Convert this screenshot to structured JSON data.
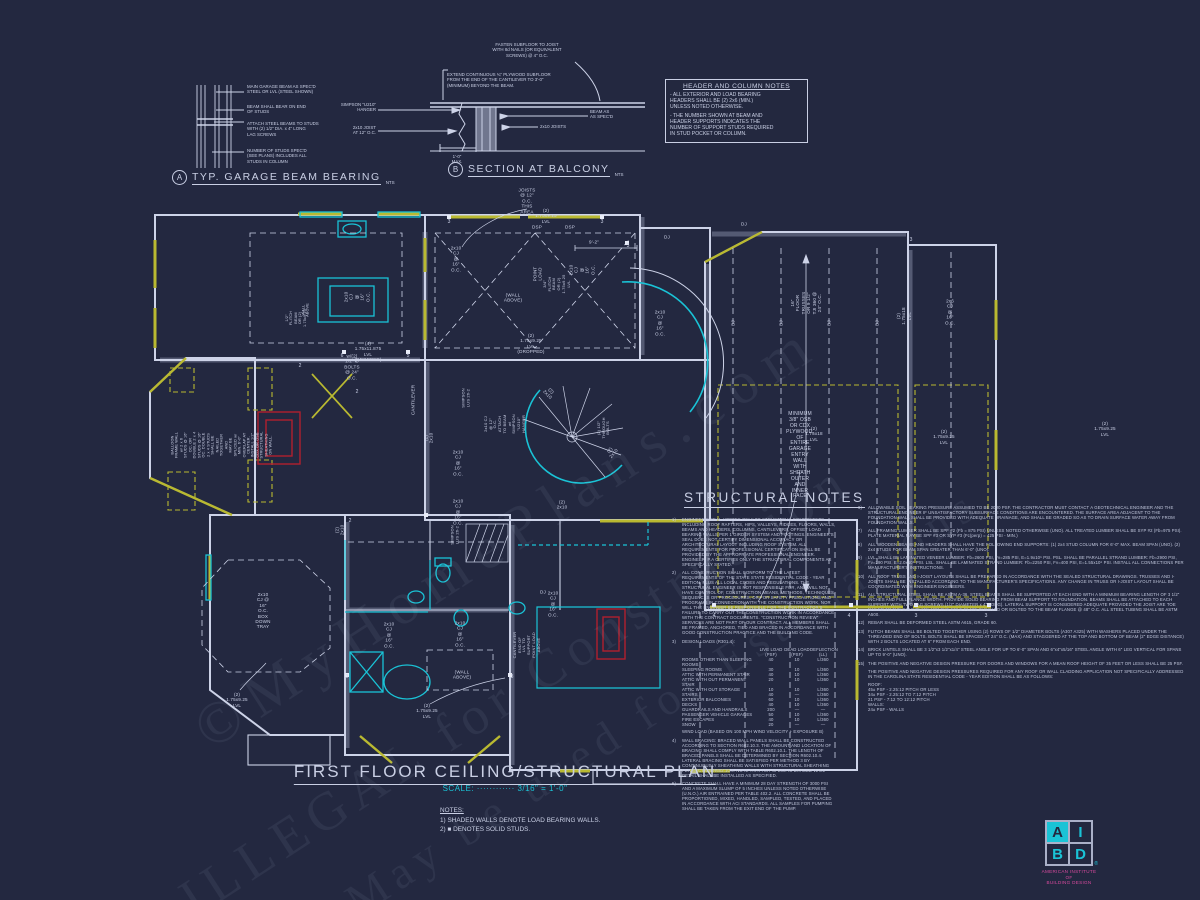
{
  "colors": {
    "bg": "#232840",
    "line": "#cdd3e8",
    "cyan": "#1ac3d6",
    "yellow": "#b9b931",
    "red": "#b01f2e",
    "magenta": "#d84a9e"
  },
  "watermark": {
    "lines": [
      "©MyHomePlans.com",
      "ILLEGAL for Construction",
      "May be used for Estimations"
    ]
  },
  "details": {
    "garage_beam": {
      "tag": "A",
      "title": "TYP. GARAGE BEAM BEARING",
      "nts": "NTS",
      "notes": [
        "MAIN GARAGE BEAM AS SPEC'D\nSTEEL OR LVL (STEEL SHOWN)",
        "BEAM SHALL BEAR ON END\nOF STUDS",
        "ATTACH STEEL BEAMS TO STUDS\nWITH (2) 1/2\" DIA. x 4\" LONG\nLAG SCREWS",
        "NUMBER OF STUDS SPEC'D\n(SEE PLANS) INCLUDES ALL\nSTUDS IN COLUMN"
      ]
    },
    "balcony": {
      "tag": "B",
      "title": "SECTION AT BALCONY",
      "nts": "NTS",
      "note_fasten": "FASTEN SUBFLOOR TO JOIST\nWITH 8d NAILS (OR EQUIVALENT\nSCREWS) @ 4\" O.C.",
      "note_extend": "EXTEND CONTINUOUS ¾\" PLYWOOD SUBFLOOR\nFROM THE END OF THE CANTILEVER TO 3'-0\"\n(MINIMUM) BEYOND THE BEAM.",
      "label_hanger": "SIMPSON \"U210\"\nHANGER",
      "label_joist": "2x10 JOIST\nAT 12\" O.C.",
      "label_beam": "BEAM AS\nAS SPEC'D",
      "label_joists2": "2x10 JOISTS",
      "label_max": "1'-0\"\nMAX."
    }
  },
  "header_notes": {
    "title": "HEADER AND COLUMN NOTES",
    "body": [
      "- ALL EXTERIOR AND LOAD BEARING\nHEADERS SHALL BE (2) 2x6 (MIN.)\nUNLESS NOTED OTHERWISE.",
      "- THE NUMBER SHOWN AT BEAM AND\nHEADER SUPPORTS INDICATES THE\nNUMBER OF SUPPORT STUDS REQUIRED\nIN STUD POCKET OR COLUMN."
    ]
  },
  "structural_notes": {
    "title": "STRUCTURAL NOTES",
    "left": [
      {
        "n": "1)",
        "t": "ENGINEER'S SEAL APPLIES ONLY TO STRUCTURAL COMPONENTS INCLUDING ROOF RAFTERS, HIPS, VALLEYS, RIDGES, FLOORS, WALLS, BEAMS AND HEADERS, COLUMNS, CANTILEVERS, OFFSET LOAD BEARING WALLS PER 1 GIRDER SYSTEM AND FOOTINGS.  ENGINEER'S SEAL DOES NOT CERTIFY DIMENSIONAL ACCURACY OR ARCHITECTURAL LAYOUT INCLUDING ROOF SYSTEM. ALL REQUIREMENTS FOR PROFESSIONAL CERTIFICATION SHALL BE PROVIDED BY THE APPROPRIATE PROFESSIONAL ENGINEER. ENGINEER, P.A CERTIFIES ONLY THE STRUCTURAL COMPONENTS AS SPECIFICALLY STATED."
      },
      {
        "n": "2)",
        "t": "ALL CONSTRUCTION SHALL CONFORM TO THE LATEST REQUIREMENTS OF THE STATE STATE RESIDENTIAL CODE - YEAR EDITION, PLUS ALL LOCAL CODES AND REGULATIONS. THE STRUCTURAL ENGINEER IS NOT RESPONSIBLE FOR, AND WILL NOT HAVE CONTROL OF, CONSTRUCTION MEANS, METHODS, TECHNIQUES, SEQUENCES OR PROCEDURES, OR FOR SAFETY PRECAUTIONS AND PROGRAMS IN CONNECTION WITH THE CONSTRUCTION WORK, NOR WILL THE ENGINEER BE RESPONSIBLE FOR THE CONTRACTOR'S FAILURE TO CARRY OUT THE CONSTRUCTION WORK IN ACCORDANCE WITH THE CONTRACT DOCUMENTS. \"CONSTRUCTION REVIEW\" SERVICES ARE NOT PART OF OUR CONTRACT. ALL MEMBERS SHALL BE FRAMED, ANCHORED, TIED AND BRACED IN ACCORDANCE WITH GOOD CONSTRUCTION PRACTICE AND THE BUILDING CODE."
      },
      {
        "table": true,
        "n": "3)"
      },
      {
        "n": "4)",
        "t": "WALL BRACING:  BRACED WALL PANELS SHALL BE CONSTRUCTED ACCORDING TO SECTION R602.10.3. THE AMOUNT AND LOCATION OF BRACING SHALL COMPLY WITH TABLE R602.10.1. THE LENGTH OF BRACED PANELS SHALL BE DETERMINED BY SECTION R602.10.4. LATERAL BRACING SHALL BE SATISFIED PER METHOD 3 BY CONTINUOUSLY SHEATHING WALLS WITH STRUCTURAL SHEATHING PER SECTION R602.10.3. NOTE THAT ANY SPECIFIC BRACED WALL DETAIL SHALL BE INSTALLED AS SPECIFIED."
      },
      {
        "n": "5)",
        "t": "CONCRETE SHALL HAVE A MINIMUM 28 DAY STRENGTH OF 3000 PSI AND A MAXIMUM SLUMP OF 5 INCHES UNLESS NOTED OTHERWISE (U.N.O.) AIR ENTRAINED PER TABLE 402.2. ALL CONCRETE SHALL BE PROPORTIONED, MIXED, HANDLED, SAMPLED, TESTED, AND PLACED IN ACCORDANCE WITH ACI STANDARDS. ALL SAMPLES FOR PUMPING SHALL BE TAKEN FROM THE EXIT END OF THE PUMP."
      }
    ],
    "table": {
      "title": "DESIGN LOADS (R301.4):",
      "col_headers": [
        "LIVE LOAD\n(PSF)",
        "DEAD LOAD\n(PSF)",
        "DEFLECTION\n(LL)"
      ],
      "rows": [
        [
          "ROOMS OTHER THAN SLEEPING ROOMS",
          "40",
          "10",
          "L/360"
        ],
        [
          "SLEEPING ROOMS",
          "30",
          "10",
          "L/360"
        ],
        [
          "ATTIC WITH PERMANENT STAIR",
          "40",
          "10",
          "L/360"
        ],
        [
          "ATTIC WITH OUT PERMANENT STAIR",
          "20",
          "10",
          "L/360"
        ],
        [
          "ATTIC WITH OUT STORAGE",
          "10",
          "10",
          "L/360"
        ],
        [
          "STAIRS",
          "40",
          "—",
          "L/360"
        ],
        [
          "EXTERIOR BALCONIES",
          "60",
          "10",
          "L/360"
        ],
        [
          "DECKS",
          "40",
          "10",
          "L/360"
        ],
        [
          "GUARDRAILS AND HANDRAILS",
          "200",
          "—",
          "—"
        ],
        [
          "PASSENGER VEHICLE GARAGES",
          "50",
          "10",
          "L/360"
        ],
        [
          "FIRE ESCAPES",
          "40",
          "10",
          "L/360"
        ],
        [
          "SNOW",
          "20",
          "—",
          "—"
        ]
      ],
      "wind": "WIND LOAD        (BASED ON 100 MPH WIND VELOCITY + EXPOSURE B)"
    },
    "right": [
      {
        "n": "6)",
        "t": "ALLOWABLE SOIL BEARING PRESSURE ASSUMED TO BE 2000 PSF. THE CONTRACTOR MUST CONTACT A GEOTECHNICAL ENGINEER AND THE STRUCTURAL ENGINEER IF UNSATISFACTORY SUBSURFACE CONDITIONS ARE ENCOUNTERED. THE SURFACE AREA ADJACENT TO THE FOUNDATION WALL SHALL BE PROVIDED WITH ADEQUATE DRAINAGE, AND SHALL BE GRADED SO AS TO DRAIN SURFACE WATER AWAY FROM FOUNDATION WALLS."
      },
      {
        "n": "7)",
        "t": "ALL FRAMING LUMBER SHALL BE SPF #2 (Fb = 875 PSI) UNLESS NOTED OTHERWISE (UNO). ALL TREATED LUMBER SHALL BE SYP #2 (Fb=975 PSI). PLATE MATERIAL MAY BE SPF #3 OR SYP #3 (Fc(perp) = 425 PSI - MIN.)"
      },
      {
        "n": "8)",
        "t": "ALL WOODEN BEAMS AND HEADERS SHALL HAVE THE FOLLOWING END SUPPORTS: (1) 2x4 STUD COLUMN FOR 6'-0\" MAX. BEAM SPAN (UNO). (2) 2x4 STUDS FOR BEAM SPAN GREATER THAN 6'-0\" (UNO)."
      },
      {
        "n": "9)",
        "t": "LVL. SHALL BE LAMINATED VENEER LUMBER: Fb=2600 PSI, Fv=285 PSI, E=1.9x10⁶ PSI. PSL. SHALL BE PARALLEL STRAND LUMBER: Fb=2900 PSI, Fv=290 PSI, E=2.0x10⁶ PSI. LSL. SHALL BE LAMINATED STRAND LUMBER: Fb=2250 PSI, Fv=400 PSI, E=1.55x10⁶ PSI. INSTALL ALL CONNECTIONS PER MANUFACTURER'S INSTRUCTIONS."
      },
      {
        "n": "10)",
        "t": "ALL ROOF TRUSS AND I-JOIST LAYOUTS SHALL BE PREPARED IN ACCORDANCE WITH THE SEALED STRUCTURAL DRAWINGS. TRUSSES AND I-JOISTS SHALL BE INSTALLED ACCORDING TO THE MANUFACTURER'S SPECIFICATIONS. ANY CHANGE IN TRUSS OR I-JOIST LAYOUT SHALL BE COORDINATED WITH ENGINEER ENGINEERS."
      },
      {
        "n": "11)",
        "t": "ALL STRUCTURAL STEEL SHALL BE ASTM A-36. STEEL BEAMS SHALL BE SUPPORTED AT EACH END WITH A MINIMUM BEARING LENGTH OF 3 1/2\" INCHES AND FULL FLANGE WIDTH. PROVIDE SOLID BEARING FROM BEAM SUPPORT TO FOUNDATION. BEAMS SHALL BE ATTACHED TO EACH SUPPORT WITH TWO LAG SCREWS (1/2\" DIAMETER x 4\" LONG). LATERAL SUPPORT IS CONSIDERED ADEQUATE PROVIDED THE JOIST ARE TOE NAILED TO THE SOLE PLATE AND THE SOLE PLATE IS NAILED OR BOLTED TO THE BEAM FLANGE @ 48\" O.C. ALL STEEL TUBING SHALL BE ASTM A500."
      },
      {
        "n": "12)",
        "t": "REBAR SHALL BE DEFORMED STEEL ASTM A615, GRADE 60."
      },
      {
        "n": "13)",
        "t": "FLITCH BEAMS SHALL BE BOLTED TOGETHER USING (2) ROWS OF 1/2\" DIAMETER BOLTS (A307 A325) WITH WASHERS PLACED UNDER THE THREADED END OF BOLTS. BOLTS SHALL BE SPACED AT 24\" O.C. (MAX) AND STAGGERED AT THE TOP AND BOTTOM OF BEAM (2\" EDGE DISTANCE) WITH 2 BOLTS LOCATED AT 6\" FROM EACH END."
      },
      {
        "n": "14)",
        "t": "BRICK LINTELS SHALL BE 3 1/2\"x3 1/2\"x1/4\" STEEL ANGLE FOR UP TO 6'-0\" SPAN AND 6\"x4\"x5/16\" STEEL ANGLE WITH 6\" LEG VERTICAL FOR SPANS UP TO 9'-0\" (UNO)."
      },
      {
        "n": "15)",
        "t": "THE POSITIVE AND NEGATIVE DESIGN PRESSURE FOR DOORS AND WINDOWS FOR A MEAN ROOF HEIGHT OF 35 FEET OR LESS SHALL BE 25 PSF."
      },
      {
        "n": "",
        "t": "THE POSITIVE AND NEGATIVE DESIGN PRESSURES REQUIRED FOR ANY ROOF OR WALL CLADDING APPLICATION NOT SPECIFICALLY ADDRESSED IN THE CAROLINA STATE RESIDENTIAL CODE - YEAR EDITION SHALL BE AS FOLLOWS:"
      },
      {
        "n": "",
        "t": "ROOF:\n    45± PSF  -  2.25:12 PITCH OR LESS\n    34± PSF  -  2.25:12 TO 7:12 PITCH\n    21 PSF  -  7:12 TO 12:12 PITCH\nWALLS:\n    24± PSF  -  WALLS"
      }
    ]
  },
  "plan": {
    "labels": [
      {
        "t": "JOISTS @ 12\" O.C.\nTHIS AREA",
        "x": 527,
        "y": 201
      },
      {
        "t": "(2) 1.75x9.25 LVL",
        "x": 546,
        "y": 216
      },
      {
        "t": "DSP",
        "x": 537,
        "y": 227
      },
      {
        "t": "DSP",
        "x": 570,
        "y": 227
      },
      {
        "t": "DJ",
        "x": 667,
        "y": 237
      },
      {
        "t": "DJ",
        "x": 744,
        "y": 224
      },
      {
        "t": "9'-2\"",
        "x": 594,
        "y": 242
      },
      {
        "t": "2x10 CJ\n@ 16\" O.C.",
        "x": 456,
        "y": 259
      },
      {
        "t": "POINT\nLOAD",
        "x": 538,
        "y": 274,
        "r": -90
      },
      {
        "t": "3/4\" FLITCH BEAM\nOR (2) 1.75x9.25 LVL",
        "x": 557,
        "y": 284,
        "r": -90,
        "s": 4
      },
      {
        "t": "2x10 CJ\n@ 16\" O.C.",
        "x": 582,
        "y": 270,
        "r": -90
      },
      {
        "t": "(WALL ABOVE)",
        "x": 513,
        "y": 298
      },
      {
        "t": "(2) 1.75x9.25 LVL\n(DROPPED)",
        "x": 531,
        "y": 344
      },
      {
        "t": "(4) 1.75x11.875 LVL (DROPPED)",
        "x": 368,
        "y": 352
      },
      {
        "t": "w/(2) 1/2\" Ø BOLTS @ 24\" O.C.",
        "x": 352,
        "y": 367
      },
      {
        "t": "1/2\" FLITCH BEAM OR (2) 1.75x9.25",
        "x": 296,
        "y": 318,
        "r": -90,
        "s": 3.8
      },
      {
        "t": "WALL ABOVE",
        "x": 306,
        "y": 310,
        "r": -90,
        "s": 3.8
      },
      {
        "t": "2x10 CJ\n@ 16\" O.C.",
        "x": 357,
        "y": 297,
        "r": -90
      },
      {
        "t": "16\" FLOOR TRUSSES\nOR 9 1/2\" TJI 360 @ 24\" O.C.",
        "x": 806,
        "y": 303,
        "r": -90
      },
      {
        "t": "BJ",
        "x": 733,
        "y": 323,
        "r": -90
      },
      {
        "t": "BJ",
        "x": 781,
        "y": 323,
        "r": -90
      },
      {
        "t": "BJ",
        "x": 829,
        "y": 323,
        "r": -90
      },
      {
        "t": "BJ",
        "x": 877,
        "y": 323,
        "r": -90
      },
      {
        "t": "2x6 CJ\n@ 16\" O.C.",
        "x": 950,
        "y": 312
      },
      {
        "t": "(2) 1.75x18 LVL",
        "x": 904,
        "y": 316,
        "r": -90
      },
      {
        "t": "2x10 CJ\n@ 16\" O.C.",
        "x": 660,
        "y": 323
      },
      {
        "t": "(2) 1.75x18 LVL",
        "x": 814,
        "y": 434
      },
      {
        "t": "(2) 1.75x9.25 LVL",
        "x": 944,
        "y": 437
      },
      {
        "t": "(2) 1.75x9.25 LVL",
        "x": 1105,
        "y": 429
      },
      {
        "t": "MINIMUM 3/8\" OSB OR CDX PLYWOOD,\nOF ENTIRE GARAGE ENTRY WALL WITH\nSHEATH OUTER AND INNER FACE",
        "x": 800,
        "y": 456,
        "s": 5
      },
      {
        "t": "BALLOON FRAME WALL w/ 2 x 6 STUDS @ 16\"\nOC, OR DOUBLE 2 x 4 STUDS @ 16\" OC. DOUBLE\n2 x 4 STUDS SHALL BE NAILED TOGETHER AND\nMAY BE SPLICED w/ MIN. 6'-0\" OVERLAP AT\nCENTER. INSTALL 1/2\" CDX OR OSB STRUCTURAL\nSHEATHING ON WALL.",
        "x": 222,
        "y": 445,
        "r": -90,
        "s": 3.8
      },
      {
        "t": "CANTILEVER",
        "x": 413,
        "y": 400,
        "r": -90
      },
      {
        "t": "SIMPSON\nLUS 26-2",
        "x": 466,
        "y": 398,
        "r": -90,
        "s": 4
      },
      {
        "t": "(2) 2x10",
        "x": 429,
        "y": 438,
        "r": -90
      },
      {
        "t": "(2) 2x10",
        "x": 340,
        "y": 530,
        "r": -90
      },
      {
        "t": "2x10 CJ\n@ 16\" O.C.",
        "x": 458,
        "y": 463
      },
      {
        "t": "2x10 CJ\n@ 16\" O.C.",
        "x": 458,
        "y": 512
      },
      {
        "t": "SIMPSON\nLUS 26-2",
        "x": 455,
        "y": 535,
        "r": -90,
        "s": 4
      },
      {
        "t": "2x10 CJ @ 12\" O.C.\nATTACH TO BEAM w/\nSIMPSON \"U210\" HANGER",
        "x": 505,
        "y": 424,
        "r": -90,
        "s": 4
      },
      {
        "t": "(2) 2x10",
        "x": 549,
        "y": 393,
        "r": 45
      },
      {
        "t": "(2) 1/2\"\nTHROUGH\nBOLTS",
        "x": 604,
        "y": 428,
        "r": -90,
        "s": 4
      },
      {
        "t": "(2) 2x10",
        "x": 612,
        "y": 452,
        "r": -50
      },
      {
        "t": "(2) 2x10",
        "x": 562,
        "y": 505
      },
      {
        "t": "2x10 CJ @ 16\" O.C.\nBOX DOWN TRAY",
        "x": 263,
        "y": 611
      },
      {
        "t": "2x10 CJ\n@ 16\" O.C.",
        "x": 389,
        "y": 635
      },
      {
        "t": "2x10 CJ\n@ 16\" O.C.",
        "x": 460,
        "y": 634
      },
      {
        "t": "2x10 CJ\n@ 16\" O.C.",
        "x": 553,
        "y": 604
      },
      {
        "t": "(WALL ABOVE)",
        "x": 462,
        "y": 675
      },
      {
        "t": "(2) 1.75x9.25 LVL",
        "x": 427,
        "y": 711
      },
      {
        "t": "(2) 1.75x9.25 LVL",
        "x": 237,
        "y": 700
      },
      {
        "t": "CANTILEVER END OF\nLVL TO SUPPORT\nPOINT LOAD ABOVE",
        "x": 527,
        "y": 645,
        "r": -90,
        "s": 4
      },
      {
        "t": "DJ",
        "x": 543,
        "y": 592
      }
    ],
    "stud_counts": [
      {
        "t": "3",
        "x": 449,
        "y": 222
      },
      {
        "t": "3",
        "x": 602,
        "y": 222
      },
      {
        "t": "3",
        "x": 628,
        "y": 246
      },
      {
        "t": "3",
        "x": 911,
        "y": 240
      },
      {
        "t": "4",
        "x": 714,
        "y": 616
      },
      {
        "t": "4",
        "x": 849,
        "y": 616
      },
      {
        "t": "3",
        "x": 916,
        "y": 616
      },
      {
        "t": "3",
        "x": 986,
        "y": 616
      },
      {
        "t": "6",
        "x": 342,
        "y": 356
      },
      {
        "t": "5",
        "x": 408,
        "y": 356
      },
      {
        "t": "2",
        "x": 357,
        "y": 392
      },
      {
        "t": "2",
        "x": 350,
        "y": 521
      },
      {
        "t": "3",
        "x": 347,
        "y": 677
      },
      {
        "t": "3",
        "x": 512,
        "y": 677
      },
      {
        "t": "2",
        "x": 300,
        "y": 366
      }
    ]
  },
  "titleblock": {
    "title": "FIRST FLOOR CEILING/STRUCTURAL PLAN",
    "scale": "SCALE: ············ 3/16\" = 1'-0\"",
    "notes_title": "NOTES:",
    "notes": [
      "1) SHADED WALLS DENOTE LOAD BEARING WALLS.",
      "2) ■ DENOTES SOLID STUDS."
    ]
  },
  "logo": {
    "letters": [
      "A",
      "I",
      "B",
      "D"
    ],
    "reg": "®",
    "caption": "AMERICAN INSTITUTE\nOF\nBUILDING DESIGN"
  }
}
